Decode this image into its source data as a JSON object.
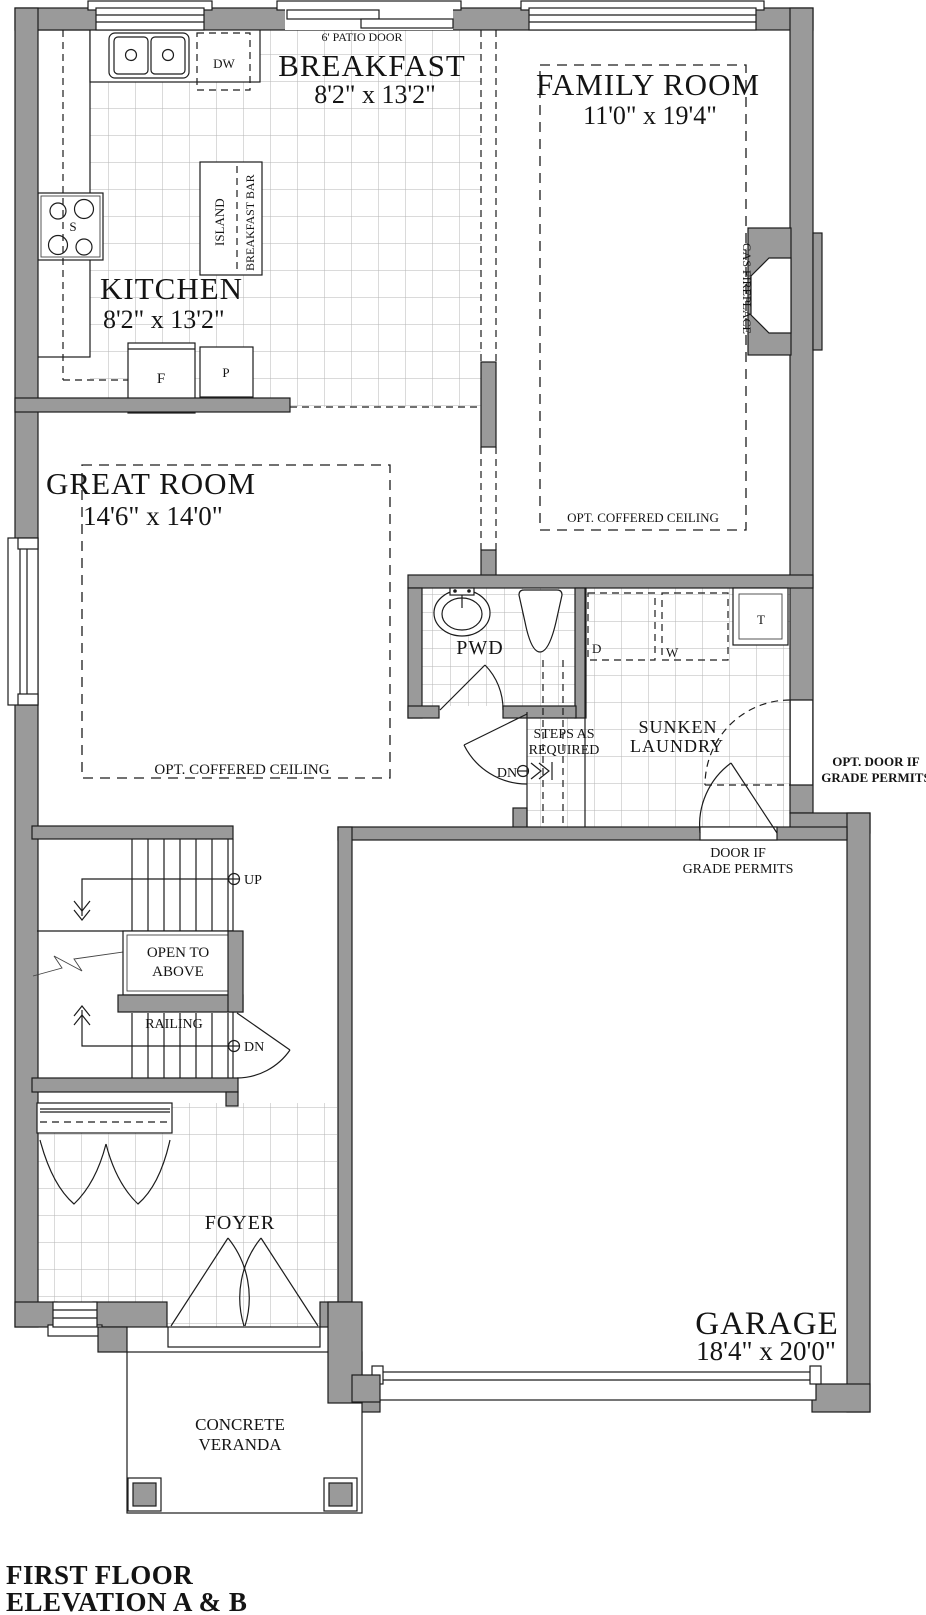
{
  "plan": {
    "rooms": {
      "breakfast": {
        "name": "BREAKFAST",
        "dims": "8'2\" x 13'2\""
      },
      "family_room": {
        "name": "FAMILY ROOM",
        "dims": "11'0\" x 19'4\"",
        "note": "OPT. COFFERED CEILING"
      },
      "kitchen": {
        "name": "KITCHEN",
        "dims": "8'2\" x 13'2\""
      },
      "great_room": {
        "name": "GREAT ROOM",
        "dims": "14'6\" x 14'0\"",
        "note": "OPT. COFFERED CEILING"
      },
      "pwd": {
        "name": "PWD"
      },
      "laundry": {
        "line1": "SUNKEN",
        "line2": "LAUNDRY"
      },
      "foyer": {
        "name": "FOYER"
      },
      "garage": {
        "name": "GARAGE",
        "dims": "18'4\" x 20'0\""
      },
      "veranda": {
        "line1": "CONCRETE",
        "line2": "VERANDA"
      },
      "open_to_above": {
        "line1": "OPEN TO",
        "line2": "ABOVE"
      }
    },
    "labels": {
      "patio_door": "6' PATIO DOOR",
      "dishwasher": "DW",
      "island": "ISLAND",
      "breakfast_bar": "BREAKFAST BAR",
      "stove": "S",
      "fridge": "F",
      "pantry": "P",
      "gas_fireplace": "GAS FIREPLACE",
      "dryer": "D",
      "washer": "W",
      "tub": "T",
      "steps_line1": "STEPS AS",
      "steps_line2": "REQUIRED",
      "dn": "DN",
      "up": "UP",
      "railing": "RAILING",
      "door_grade_line1": "DOOR IF",
      "door_grade_line2": "GRADE PERMITS",
      "opt_door_line1": "OPT. DOOR IF",
      "opt_door_line2": "GRADE PERMITS"
    },
    "title": {
      "line1": "FIRST FLOOR",
      "line2": "ELEVATION A & B"
    },
    "colors": {
      "wall": "#9a9a9a",
      "line": "#1c1c1c",
      "tile_grid": "#b5b5b5"
    }
  }
}
